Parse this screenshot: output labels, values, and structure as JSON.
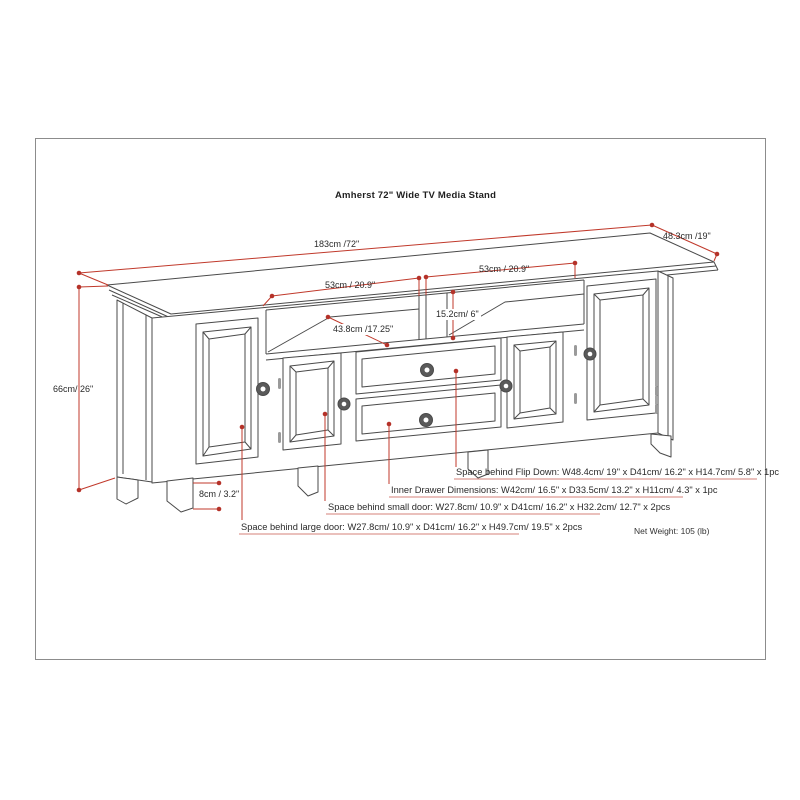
{
  "title": "Amherst 72\" Wide TV Media Stand",
  "dims": {
    "top_width": "183cm /72\"",
    "top_depth": "48.3cm /19\"",
    "shelf_left_width": "53cm / 20.9\"",
    "shelf_right_width": "53cm / 20.9\"",
    "shelf_depth": "43.8cm /17.25\"",
    "shelf_height": "15.2cm/ 6\"",
    "overall_height": "66cm/ 26\"",
    "leg_height": "8cm / 3.2\""
  },
  "notes": {
    "flip_down": "Space behind Flip Down: W48.4cm/ 19\" x D41cm/ 16.2\" x H14.7cm/ 5.8\" x 1pc",
    "inner_drawer": "Inner Drawer Dimensions: W42cm/ 16.5\" x D33.5cm/ 13.2\" x H11cm/ 4.3\" x 1pc",
    "small_door": "Space behind small door: W27.8cm/ 10.9\" x D41cm/ 16.2\" x H32.2cm/ 12.7\" x 2pcs",
    "large_door": "Space behind large door: W27.8cm/ 10.9\" x D41cm/ 16.2\" x H49.7cm/ 19.5\" x 2pcs"
  },
  "net_weight": "Net Weight: 105 (lb)",
  "colors": {
    "artwork_line": "#4a4a4a",
    "dimension_red": "#c0392b",
    "underline_red": "#d4827a",
    "frame_border": "#8c8c8c",
    "text": "#2a2a2a"
  }
}
